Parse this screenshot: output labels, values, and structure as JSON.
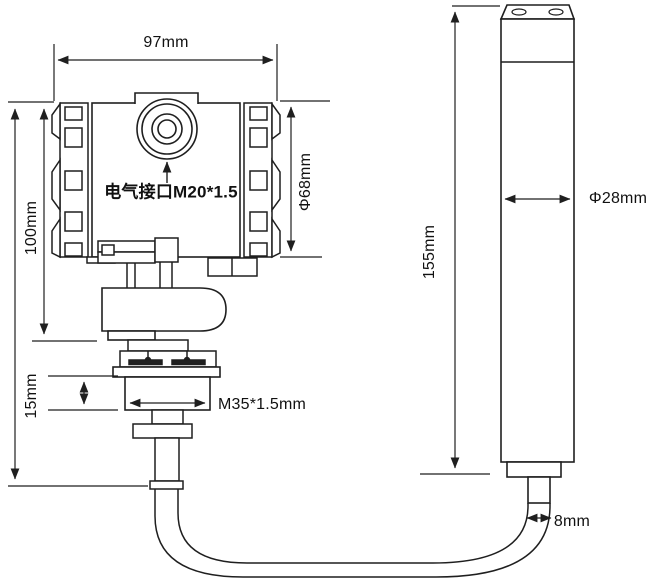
{
  "diagram": {
    "type": "technical-dimension-drawing",
    "background": "#ffffff",
    "line_color": "#1f1f1f",
    "text_color": "#111111",
    "labels": {
      "body_width": "97mm",
      "body_height": "100mm",
      "electrical_port": "电气接口M20*1.5",
      "housing_diameter": "Φ68mm",
      "thread_length": "15mm",
      "thread_spec": "M35*1.5mm",
      "probe_length": "155mm",
      "probe_diameter": "Φ28mm",
      "cable_diameter": "8mm"
    }
  }
}
